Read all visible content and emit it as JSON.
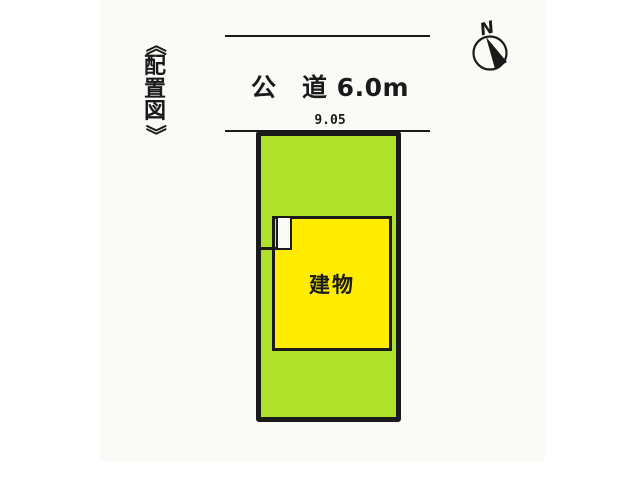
{
  "diagram": {
    "title": "《配置図》",
    "road": {
      "label": "公　道 6.0m"
    },
    "site": {
      "frontage": "9.05"
    },
    "building": {
      "label": "建物"
    },
    "compass": {
      "north_label": "N"
    }
  },
  "colors": {
    "page": "#ffffff",
    "paper": "#fafaf7",
    "ink": "#1a1a1a",
    "plot-green": "#afe02a",
    "building-yellow": "#ffec00"
  }
}
